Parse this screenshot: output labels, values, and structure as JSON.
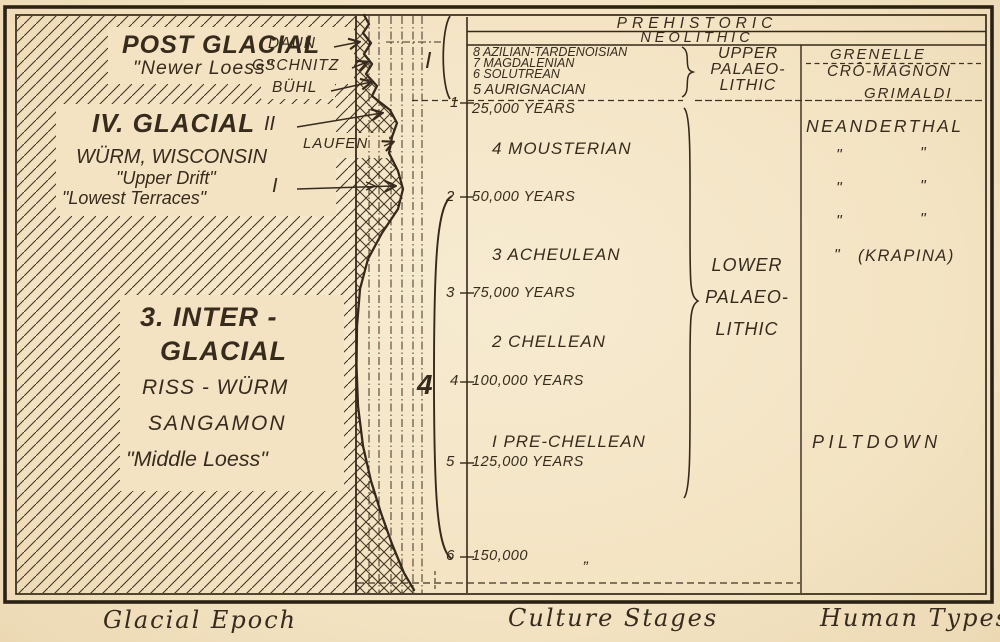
{
  "palette": {
    "paper": "#f3e3c2",
    "ink": "#372b1d"
  },
  "header": {
    "prehistoric": "PREHISTORIC",
    "neolithic": "NEOLITHIC"
  },
  "upper_culture_stages": [
    "8 AZILIAN-TARDENOISIAN",
    "7 MAGDALENIAN",
    "6 SOLUTREAN",
    "5 AURIGNACIAN"
  ],
  "upper_palaeolithic": {
    "l1": "UPPER",
    "l2": "PALAEO-",
    "l3": "LITHIC"
  },
  "lower_palaeolithic": {
    "l1": "LOWER",
    "l2": "PALAEO-",
    "l3": "LITHIC"
  },
  "culture_stages": {
    "mousterian": "4 MOUSTERIAN",
    "acheulean": "3 ACHEULEAN",
    "chellean": "2 CHELLEAN",
    "prechellean": "I PRE-CHELLEAN"
  },
  "timeline": {
    "ticks": [
      {
        "n": "1",
        "label": "25,000 YEARS"
      },
      {
        "n": "2",
        "label": "50,000 YEARS"
      },
      {
        "n": "3",
        "label": "75,000 YEARS"
      },
      {
        "n": "4",
        "label": "100,000 YEARS"
      },
      {
        "n": "5",
        "label": "125,000 YEARS"
      },
      {
        "n": "6",
        "label": "150,000"
      }
    ],
    "ditto_low": "„",
    "big_roman_one": "I",
    "big_four": "4"
  },
  "human_types": {
    "grenelle": "GRENELLE",
    "cro_magnon": "CRÔ-MAGNON",
    "grimaldi": "GRIMALDI",
    "neanderthal": "NEANDERTHAL",
    "ditto": "\"",
    "krapina_quote": "\"",
    "krapina": "(KRAPINA)",
    "piltdown": "PILTDOWN"
  },
  "glacial": {
    "post_title": "POST GLACIAL",
    "post_sub": "\"Newer Loess\"",
    "daun": "DAUN",
    "gschnitz": "GSCHNITZ",
    "buhl": "BÜHL",
    "iv_title": "IV. GLACIAL",
    "iv_line1": "WÜRM, WISCONSIN",
    "iv_line2": "\"Upper Drift\"",
    "iv_line3": "\"Lowest Terraces\"",
    "roman_two": "II",
    "laufen": "LAUFEN",
    "roman_one": "I",
    "inter_line1": "3. INTER -",
    "inter_line2": "GLACIAL",
    "inter_line3": "RISS - WÜRM",
    "inter_line4": "SANGAMON",
    "inter_line5": "\"Middle Loess\""
  },
  "captions": {
    "left": "Glacial Epoch",
    "middle": "Culture Stages",
    "right": "Human Types"
  }
}
